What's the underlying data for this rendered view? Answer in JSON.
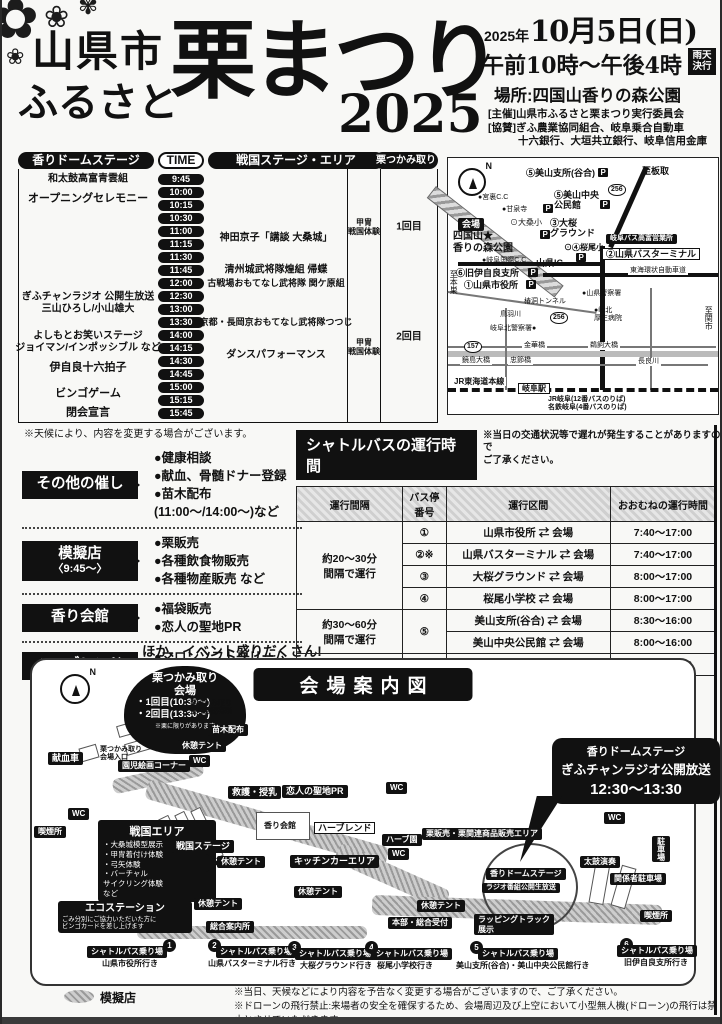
{
  "header": {
    "city": "山県市",
    "furusato": "ふるさと",
    "title_main": "栗まつり",
    "year_big": "2025",
    "date_prefix": "2025年",
    "date_main": "10月5日(日)",
    "time_line": "午前10時〜午後4時",
    "rain_badge": "雨天決行",
    "place": "場所:四国山香りの森公園",
    "org1": "[主催]山県市ふるさと栗まつり実行委員会",
    "org2": "[協賛]ぎふ農業協同組合、岐阜乗合自動車",
    "org3": "十六銀行、大垣共立銀行、岐阜信用金庫"
  },
  "schedule": {
    "headers": {
      "dome": "香りドームステージ",
      "time": "TIME",
      "sengoku": "戦国ステージ・エリア",
      "kuri": "栗つかみ取り"
    },
    "times": [
      "9:45",
      "10:00",
      "10:15",
      "10:30",
      "11:00",
      "11:15",
      "11:30",
      "11:45",
      "12:00",
      "12:30",
      "13:00",
      "13:30",
      "14:00",
      "14:15",
      "14:30",
      "14:45",
      "15:00",
      "15:15",
      "15:45"
    ],
    "events": [
      {
        "t": "和太鼓高富青雲組",
        "x": 70,
        "y": 27,
        "c": "pl f10 b ctr",
        "n": "event-taiko"
      },
      {
        "t": "オープニングセレモニー",
        "x": 70,
        "y": 47,
        "c": "pl f11 b ctr",
        "n": "event-opening"
      },
      {
        "t": "ぎふチャンラジオ 公開生放送\n三山ひろし/小山雄大",
        "x": 70,
        "y": 151,
        "c": "pl f10 b ctr",
        "n": "event-radio"
      },
      {
        "t": "よしもとお笑いステージ\nジョイマン/インポッシブル など",
        "x": 70,
        "y": 190,
        "c": "pl f10 b ctr",
        "n": "event-yoshimoto"
      },
      {
        "t": "伊自良十六拍子",
        "x": 70,
        "y": 216,
        "c": "pl f11 b ctr",
        "n": "event-ijira"
      },
      {
        "t": "ビンゴゲーム",
        "x": 70,
        "y": 242,
        "c": "pl f11 b ctr",
        "n": "event-bingo"
      },
      {
        "t": "閉会宣言",
        "x": 70,
        "y": 261,
        "c": "pl f11 b ctr",
        "n": "event-closing"
      },
      {
        "t": "神田京子「講談 大桑城」",
        "x": 258,
        "y": 86,
        "c": "pl f10 b ctr",
        "n": "event-kodan"
      },
      {
        "t": "清州城武将隊煌組 帰蝶",
        "x": 258,
        "y": 118,
        "c": "pl f10 b ctr",
        "n": "event-kiyosu"
      },
      {
        "t": "古戦場おもてなし武将隊 関ケ原組",
        "x": 258,
        "y": 131,
        "c": "pl f9 b ctr",
        "n": "event-sekigahara"
      },
      {
        "t": "京都・長岡京おもてなし武将隊つつじ",
        "x": 258,
        "y": 170,
        "c": "pl f9 b ctr",
        "n": "event-nagaokakyo"
      },
      {
        "t": "ダンスパフォーマンス",
        "x": 258,
        "y": 203,
        "c": "pl f10 b ctr",
        "n": "event-dance"
      },
      {
        "t": "甲冑\n戦国体験",
        "x": 346,
        "y": 75,
        "c": "pl f8 b ctr",
        "n": "event-armor-1"
      },
      {
        "t": "甲冑\n戦国体験",
        "x": 346,
        "y": 195,
        "c": "pl f8 b ctr",
        "n": "event-armor-2"
      },
      {
        "t": "1回目",
        "x": 391,
        "y": 75,
        "c": "pl f10 b ctr",
        "n": "kuri-round-1"
      },
      {
        "t": "2回目",
        "x": 391,
        "y": 185,
        "c": "pl f10 b ctr",
        "n": "kuri-round-2"
      }
    ],
    "note": "※天候により、内容を変更する場合がございます。"
  },
  "extras": {
    "groups": [
      {
        "title": "その他の催し",
        "items": [
          "●健康相談",
          "●献血、骨髄ドナー登録",
          "●苗木配布(11:00〜/14:00〜)など"
        ]
      },
      {
        "title": "模擬店",
        "sub": "〈9:45〜〉",
        "items": [
          "●栗販売",
          "●各種飲食物販売",
          "●各種物産販売 など"
        ]
      },
      {
        "title": "香り会館",
        "items": [
          "●福袋販売",
          "●恋人の聖地PR"
        ]
      },
      {
        "title": "ハーブレンド",
        "items": [
          "●マロンソフトクリーム",
          "●新助焼き餃子"
        ]
      }
    ],
    "more": "ほか、イベント盛りだくさん!"
  },
  "shuttle": {
    "title": "シャトルバスの運行時間",
    "note": "※当日の交通状況等で遅れが発生することがありますので\nご了承ください。",
    "col_headers": [
      "運行間隔",
      "バス停\n番号",
      "運行区間",
      "おおむねの運行時間"
    ],
    "intervals": [
      "約20〜30分\n間隔で運行",
      "約30〜60分\n間隔で運行",
      "約50分間隔で運行"
    ],
    "rows": [
      {
        "no": "①",
        "route": "山県市役所 ⇄ 会場",
        "time": "7:40〜17:00"
      },
      {
        "no": "②※",
        "route": "山県バスターミナル ⇄ 会場",
        "time": "7:40〜17:00"
      },
      {
        "no": "③",
        "route": "大桜グラウンド ⇄ 会場",
        "time": "8:00〜17:00"
      },
      {
        "no": "④",
        "route": "桜尾小学校 ⇄ 会場",
        "time": "8:00〜17:00"
      },
      {
        "no": "⑤",
        "route": "美山支所(谷合) ⇄ 会場",
        "time": "8:30〜16:00"
      },
      {
        "route": "美山中央公民館 ⇄ 会場",
        "time": "8:00〜16:00"
      },
      {
        "no": "⑥",
        "route": "旧伊自良支所 ⇄ 会場",
        "time": "7:30〜17:00"
      }
    ],
    "footnote": "※②山県バスターミナルには、栗まつり来場者用の駐車場はありません。"
  },
  "minimap": {
    "labels": [
      {
        "t": "至板取",
        "x": 194,
        "y": 8,
        "c": "pl f9 b",
        "n": "to-itadori"
      },
      {
        "t": "⑤美山支所(谷合)",
        "x": 78,
        "y": 10,
        "c": "pl f9 b",
        "n": "miyama-branch"
      },
      {
        "t": "P",
        "x": 150,
        "y": 10,
        "c": "picon",
        "n": "parking-icon"
      },
      {
        "t": "256",
        "x": 160,
        "y": 26,
        "c": "shield",
        "n": "route-256-shield"
      },
      {
        "t": "⑤美山中央\n公民館",
        "x": 106,
        "y": 32,
        "c": "pl f9 b",
        "n": "miyama-hall"
      },
      {
        "t": "P",
        "x": 152,
        "y": 42,
        "c": "picon",
        "n": "parking-icon"
      },
      {
        "t": "●宮裏C.C",
        "x": 30,
        "y": 36,
        "c": "pl f7",
        "n": "golf-club"
      },
      {
        "t": "●甘泉寺",
        "x": 54,
        "y": 48,
        "c": "pl f7",
        "n": "temple"
      },
      {
        "t": "P",
        "x": 95,
        "y": 46,
        "c": "picon",
        "n": "parking-icon"
      },
      {
        "t": "⊙大桑小",
        "x": 62,
        "y": 60,
        "c": "pl f8",
        "n": "okuwa-school"
      },
      {
        "t": "③大桜\nグラウンド",
        "x": 102,
        "y": 60,
        "c": "pl f9 b",
        "n": "osakura-ground"
      },
      {
        "t": "P",
        "x": 92,
        "y": 72,
        "c": "picon",
        "n": "parking-icon"
      },
      {
        "t": "会場",
        "x": 10,
        "y": 60,
        "c": "bk f9",
        "n": "venue-badge"
      },
      {
        "t": "四国山★\n香りの森公園",
        "x": 5,
        "y": 73,
        "c": "pl f10 b",
        "n": "venue-name"
      },
      {
        "t": "⊙④桜尾小",
        "x": 116,
        "y": 85,
        "c": "pl f8 b",
        "n": "sakurao-school"
      },
      {
        "t": "P",
        "x": 128,
        "y": 95,
        "c": "picon",
        "n": "parking-icon"
      },
      {
        "t": "岐阜バス高富営業所",
        "x": 158,
        "y": 76,
        "c": "bk f7",
        "n": "gifu-bus-office"
      },
      {
        "t": "②山県バスターミナル",
        "x": 154,
        "y": 90,
        "c": "wt f9 b",
        "n": "yamagata-bus-terminal"
      },
      {
        "t": "山県IC",
        "x": 88,
        "y": 100,
        "c": "pl f9 b",
        "n": "yamagata-ic"
      },
      {
        "t": "●岐阜国際C.C",
        "x": 34,
        "y": 99,
        "c": "pl f7",
        "n": "gifu-intl-cc"
      },
      {
        "t": "⑥旧伊自良支所",
        "x": 8,
        "y": 110,
        "c": "pl f9 b",
        "n": "ijira-branch"
      },
      {
        "t": "P",
        "x": 80,
        "y": 110,
        "c": "picon",
        "n": "parking-icon"
      },
      {
        "t": "東海環状自動車道",
        "x": 180,
        "y": 109,
        "c": "pl f7 wbg",
        "n": "tokai-kanjo-expwy"
      },
      {
        "t": "①山県市役所",
        "x": 16,
        "y": 122,
        "c": "pl f9 b",
        "n": "city-hall"
      },
      {
        "t": "P",
        "x": 78,
        "y": 122,
        "c": "picon",
        "n": "parking-icon"
      },
      {
        "t": "至本巣",
        "x": 1,
        "y": 112,
        "c": "pl f8 vert",
        "n": "to-motosu"
      },
      {
        "t": "●山県警察署",
        "x": 134,
        "y": 132,
        "c": "pl f7",
        "n": "yamagata-police"
      },
      {
        "t": "椿洞トンネル",
        "x": 76,
        "y": 140,
        "c": "pl f7",
        "n": "tunnel"
      },
      {
        "t": "256",
        "x": 102,
        "y": 154,
        "c": "shield",
        "n": "route-256-shield"
      },
      {
        "t": "●岐北\n厚生病院",
        "x": 146,
        "y": 149,
        "c": "pl f7",
        "n": "gihoku-hospital"
      },
      {
        "t": "鳥羽川",
        "x": 52,
        "y": 153,
        "c": "pl f7",
        "n": "toba-river"
      },
      {
        "t": "岐阜北警察署●",
        "x": 42,
        "y": 167,
        "c": "pl f7",
        "n": "gifu-kita-police"
      },
      {
        "t": "157",
        "x": 16,
        "y": 183,
        "c": "shield",
        "n": "route-157-shield"
      },
      {
        "t": "金華橋",
        "x": 74,
        "y": 184,
        "c": "pl f7 wbg",
        "n": "kinka-bridge"
      },
      {
        "t": "鵜飼大橋",
        "x": 140,
        "y": 184,
        "c": "pl f7 wbg",
        "n": "ukai-bridge"
      },
      {
        "t": "鏡島大橋",
        "x": 12,
        "y": 199,
        "c": "pl f7 wbg",
        "n": "kagashima-bridge"
      },
      {
        "t": "忠節橋",
        "x": 60,
        "y": 199,
        "c": "pl f7 wbg",
        "n": "chusetsu-bridge"
      },
      {
        "t": "長良川",
        "x": 188,
        "y": 200,
        "c": "pl f7 wbg",
        "n": "nagara-river"
      },
      {
        "t": "JR東海道本線",
        "x": 4,
        "y": 219,
        "c": "pl f8 b wbg",
        "n": "jr-tokaido-line"
      },
      {
        "t": "岐阜駅",
        "x": 70,
        "y": 225,
        "c": "wt f8 b",
        "n": "gifu-station"
      },
      {
        "t": "JR岐阜(12番バスのりば)\n名鉄岐阜(4番バスのりば)",
        "x": 100,
        "y": 238,
        "c": "pl f7 b",
        "n": "gifu-bus-stops"
      },
      {
        "t": "至関市",
        "x": 256,
        "y": 148,
        "c": "pl f8 vert",
        "n": "to-seki"
      }
    ]
  },
  "venue": {
    "title": "会場案内図",
    "chestnut": {
      "l1": "栗つかみ取り\n会場",
      "l2": "・1回目(10:30〜)\n・2回目(13:30〜)",
      "l3": "※栗に限りがあります"
    },
    "sengoku_box": {
      "title": "戦国エリア",
      "lines": [
        "・大桑城模型展示",
        "・甲冑着付け体験",
        "・弓矢体験",
        "・バーチャル\n  サイクリング体験",
        "              など"
      ]
    },
    "eco_box": {
      "title": "エコステーション",
      "lines": [
        "ごみ分別にご協力いただいた方に",
        "ビンゴカードを差し上げます"
      ]
    },
    "bubble": {
      "l1": "香りドームステージ",
      "l2": "ぎふチャンラジオ公開放送",
      "l3": "12:30〜13:30"
    },
    "labels": [
      {
        "t": "献血車",
        "x": 16,
        "y": 92,
        "c": "bk",
        "n": "blood-donation"
      },
      {
        "t": "栗つかみ取り\n会場入口",
        "x": 68,
        "y": 86,
        "c": "pl f7 b",
        "n": "kuri-entrance"
      },
      {
        "t": "栗つかみ取り\n整理券配布所",
        "x": 158,
        "y": 40,
        "c": "pl f7 b",
        "n": "kuri-ticket"
      },
      {
        "t": "苗木配布",
        "x": 176,
        "y": 64,
        "c": "bk f8",
        "n": "sapling-handout"
      },
      {
        "t": "休憩テント",
        "x": 146,
        "y": 80,
        "c": "bk f8",
        "n": "rest-tent"
      },
      {
        "t": "WC",
        "x": 157,
        "y": 95,
        "c": "bk f8",
        "n": "wc"
      },
      {
        "t": "園児絵画コーナー",
        "x": 86,
        "y": 100,
        "c": "bk f8",
        "n": "kids-art-corner"
      },
      {
        "t": "WC",
        "x": 36,
        "y": 148,
        "c": "bk f8",
        "n": "wc"
      },
      {
        "t": "喫煙所",
        "x": 2,
        "y": 166,
        "c": "bk f8",
        "n": "smoking-area"
      },
      {
        "t": "戦国ステージ",
        "x": 140,
        "y": 180,
        "c": "bk",
        "n": "sengoku-stage"
      },
      {
        "t": "休憩テント",
        "x": 185,
        "y": 196,
        "c": "bk f8",
        "n": "rest-tent"
      },
      {
        "t": "休憩テント",
        "x": 162,
        "y": 238,
        "c": "bk f8",
        "n": "rest-tent"
      },
      {
        "t": "救護・授乳",
        "x": 196,
        "y": 126,
        "c": "bk",
        "n": "first-aid-nursing"
      },
      {
        "t": "恋人の聖地PR",
        "x": 250,
        "y": 125,
        "c": "bk",
        "n": "lovers-sanctuary-pr"
      },
      {
        "t": "香り会館",
        "x": 232,
        "y": 161,
        "c": "pl f8 b",
        "n": "kaori-kaikan"
      },
      {
        "t": "ハーブレンド",
        "x": 282,
        "y": 162,
        "c": "wt f9",
        "n": "herblend"
      },
      {
        "t": "キッチンカーエリア",
        "x": 258,
        "y": 195,
        "c": "bk",
        "n": "kitchen-car-area"
      },
      {
        "t": "休憩テント",
        "x": 262,
        "y": 226,
        "c": "bk f8",
        "n": "rest-tent"
      },
      {
        "t": "WC",
        "x": 354,
        "y": 122,
        "c": "bk f8",
        "n": "wc"
      },
      {
        "t": "ハーブ園",
        "x": 350,
        "y": 174,
        "c": "bk f8",
        "n": "herb-garden"
      },
      {
        "t": "WC",
        "x": 356,
        "y": 188,
        "c": "bk f8",
        "n": "wc"
      },
      {
        "t": "栗販売・栗関連商品販売エリア",
        "x": 390,
        "y": 168,
        "c": "bk f8",
        "n": "kuri-sales-area"
      },
      {
        "t": "WC",
        "x": 572,
        "y": 152,
        "c": "bk f8",
        "n": "wc"
      },
      {
        "t": "休憩テント",
        "x": 385,
        "y": 240,
        "c": "bk f8",
        "n": "rest-tent"
      },
      {
        "t": "本部・総合受付",
        "x": 356,
        "y": 257,
        "c": "bk f8",
        "n": "hq-reception"
      },
      {
        "t": "ラッピングトラック\n展示",
        "x": 442,
        "y": 254,
        "c": "bk f8",
        "n": "wrapping-truck"
      },
      {
        "t": "香りドームステージ",
        "x": 454,
        "y": 208,
        "c": "bk f8",
        "n": "dome-stage-label"
      },
      {
        "t": "ラジオ番組公開生放送",
        "x": 450,
        "y": 223,
        "c": "bk f7",
        "n": "radio-live-label"
      },
      {
        "t": "太鼓演奏",
        "x": 548,
        "y": 196,
        "c": "bk f8",
        "n": "taiko-spot"
      },
      {
        "t": "関係者駐車場",
        "x": 578,
        "y": 213,
        "c": "bk f8",
        "n": "staff-parking"
      },
      {
        "t": "喫煙所",
        "x": 608,
        "y": 250,
        "c": "bk f8",
        "n": "smoking-area"
      },
      {
        "t": "駐車場",
        "x": 620,
        "y": 176,
        "c": "bk f8 vert",
        "n": "parking"
      },
      {
        "t": "総合案内所",
        "x": 174,
        "y": 261,
        "c": "bk f8",
        "n": "information"
      },
      {
        "t": "1",
        "x": 131,
        "y": 279,
        "c": "stopdot",
        "n": "bus-stop-1"
      },
      {
        "t": "シャトルバス乗り場",
        "x": 55,
        "y": 286,
        "c": "bk f8",
        "n": "shuttle-stop-label"
      },
      {
        "t": "山県市役所行き",
        "x": 70,
        "y": 299,
        "c": "pl f8 b",
        "n": "stop1-dest"
      },
      {
        "t": "2",
        "x": 176,
        "y": 279,
        "c": "stopdot",
        "n": "bus-stop-2"
      },
      {
        "t": "シャトルバス乗り場",
        "x": 184,
        "y": 286,
        "c": "bk f8",
        "n": "shuttle-stop-label"
      },
      {
        "t": "山県バスターミナル行き",
        "x": 176,
        "y": 299,
        "c": "pl f8 b",
        "n": "stop2-dest"
      },
      {
        "t": "3",
        "x": 256,
        "y": 281,
        "c": "stopdot",
        "n": "bus-stop-3"
      },
      {
        "t": "シャトルバス乗り場",
        "x": 263,
        "y": 288,
        "c": "bk f8",
        "n": "shuttle-stop-label"
      },
      {
        "t": "大桜グラウンド行き",
        "x": 268,
        "y": 301,
        "c": "pl f8 b",
        "n": "stop3-dest"
      },
      {
        "t": "4",
        "x": 333,
        "y": 281,
        "c": "stopdot",
        "n": "bus-stop-4"
      },
      {
        "t": "シャトルバス乗り場",
        "x": 340,
        "y": 288,
        "c": "bk f8",
        "n": "shuttle-stop-label"
      },
      {
        "t": "桜尾小学校行き",
        "x": 345,
        "y": 301,
        "c": "pl f8 b",
        "n": "stop4-dest"
      },
      {
        "t": "5",
        "x": 438,
        "y": 281,
        "c": "stopdot",
        "n": "bus-stop-5"
      },
      {
        "t": "シャトルバス乗り場",
        "x": 446,
        "y": 288,
        "c": "bk f8",
        "n": "shuttle-stop-label"
      },
      {
        "t": "美山支所(谷合)・美山中央公民館行き",
        "x": 424,
        "y": 301,
        "c": "pl f8 b",
        "n": "stop5-dest"
      },
      {
        "t": "6",
        "x": 588,
        "y": 278,
        "c": "stopdot",
        "n": "bus-stop-6"
      },
      {
        "t": "シャトルバス乗り場",
        "x": 585,
        "y": 285,
        "c": "bk f8",
        "n": "shuttle-stop-label"
      },
      {
        "t": "旧伊自良支所行き",
        "x": 592,
        "y": 298,
        "c": "pl f8 b",
        "n": "stop6-dest"
      }
    ]
  },
  "footer": {
    "legend": "模擬店",
    "note1": "※当日、天候などにより内容を予告なく変更する場合がございますので、ご了承ください。",
    "note2": "※ドローンの飛行禁止:来場者の安全を確保するため、会場周辺及び上空において小型無人機(ドローン)の飛行は禁止とさせていただきます。"
  }
}
